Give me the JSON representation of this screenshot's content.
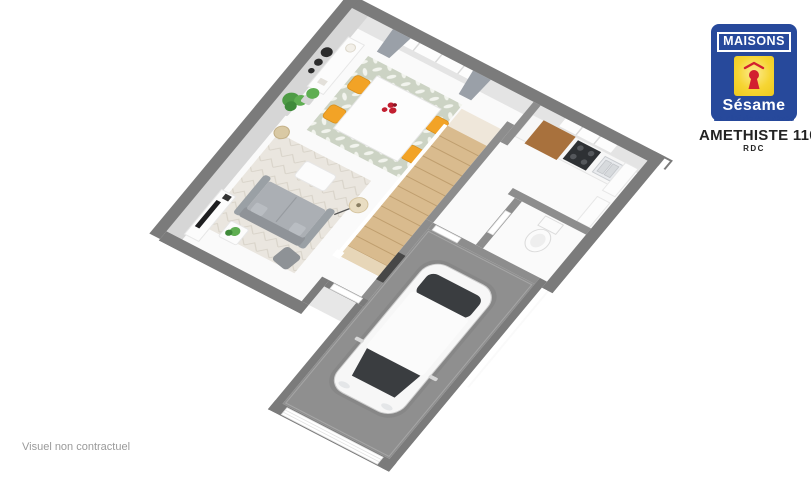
{
  "branding": {
    "name_top": "MAISONS",
    "name_bottom": "Sésame",
    "tagline": "La clef de vos rêves"
  },
  "plan": {
    "title": "AMETHISTE 110 GI",
    "floor_label": "RDC"
  },
  "footer": {
    "disclaimer": "Visuel non contractuel"
  },
  "icons": [
    {
      "name": "keyhole-icon",
      "color": "#d2202f"
    }
  ],
  "palette": {
    "logo_blue": "#27499b",
    "logo_yellow": "#f6d532",
    "logo_red": "#d2202f",
    "wall_gray": "#7b7b7b",
    "interior_wall": "#8d8d8d",
    "wall_face": "#d6d6d6",
    "floor_white": "#fafafa",
    "garage_floor": "#8f8f8f",
    "wood_stairs": "#d9bb8e",
    "wood_counter": "#a8713d",
    "chair_orange": "#f2a326",
    "sofa_gray": "#abafb4",
    "plant_green": "#4e9b45",
    "flower_red": "#c21f31",
    "curtain_gray": "#9aa0a8",
    "car_glass": "#3a3d40"
  },
  "scene": {
    "view": "3D axonometric floor plan of ground floor",
    "rooms": [
      "séjour-salle à manger",
      "cuisine",
      "wc",
      "dégagement",
      "entrée",
      "garage"
    ],
    "objects": [
      "canapé gris",
      "tapis",
      "meuble TV",
      "lampadaire",
      "plantes vertes",
      "buffet",
      "miroirs muraux",
      "table à manger blanche",
      "4 chaises orange",
      "bouquet rouge",
      "baie vitrée avec rideaux gris",
      "escalier bois",
      "plan de travail cuisine",
      "plaque de cuisson noire",
      "évier",
      "colonne réfrigérateur",
      "toilettes",
      "voiture blanche",
      "porte de garage",
      "porte d'entrée"
    ]
  }
}
